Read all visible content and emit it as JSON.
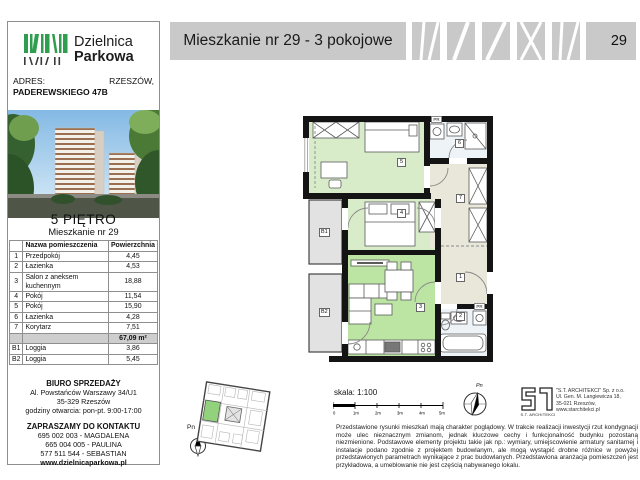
{
  "header": {
    "logo_line1": "Dzielnica",
    "logo_line2": "Parkowa",
    "address_label": "ADRES:",
    "address_city": "RZESZÓW,",
    "address_street": "PADEREWSKIEGO 47B",
    "title": "Mieszkanie nr 29 - 3 pokojowe",
    "unit_number": "29"
  },
  "left_panel": {
    "floor": "5 PIĘTRO",
    "unit": "Mieszkanie nr 29",
    "table": {
      "col_name": "Nazwa pomieszczenia",
      "col_area": "Powierzchnia",
      "rows": [
        {
          "no": "1",
          "name": "Przedpokój",
          "area": "4,45"
        },
        {
          "no": "2",
          "name": "Łazienka",
          "area": "4,53"
        },
        {
          "no": "3",
          "name": "Salon z aneksem kuchennym",
          "area": "18,88"
        },
        {
          "no": "4",
          "name": "Pokój",
          "area": "11,54"
        },
        {
          "no": "5",
          "name": "Pokój",
          "area": "15,90"
        },
        {
          "no": "6",
          "name": "Łazienka",
          "area": "4,28"
        },
        {
          "no": "7",
          "name": "Korytarz",
          "area": "7,51"
        }
      ],
      "total": "67,09 m²",
      "extra_rows": [
        {
          "no": "B1",
          "name": "Loggia",
          "area": "3,86"
        },
        {
          "no": "B2",
          "name": "Loggia",
          "area": "5,45"
        }
      ]
    },
    "office": {
      "title": "BIURO SPRZEDAŻY",
      "line1": "Al. Powstańców Warszawy 34/U1",
      "line2": "35-329 Rzeszów",
      "line3": "godziny otwarcia: pon-pt. 9:00-17:00",
      "contact_title": "ZAPRASZAMY DO KONTAKTU",
      "phone1": "695 002 003 - MAGDALENA",
      "phone2": "665 004 005 - PAULINA",
      "phone3": "577 511 544 - SEBASTIAN",
      "website": "www.dzielnicaparkowa.pl"
    }
  },
  "plan": {
    "room_labels": {
      "r1": "1",
      "r2": "2",
      "r3": "3",
      "r4": "4",
      "r5": "5",
      "r6": "6",
      "r7": "7",
      "b1": "B1",
      "b2": "B2"
    },
    "appliance_labels": {
      "pr_top": "PR",
      "pr_bottom": "PR"
    }
  },
  "footer": {
    "scale_label": "skala: 1:100",
    "scale_ticks": [
      "0",
      "1m",
      "2m",
      "3m",
      "4m",
      "5m"
    ],
    "north_label": "Pn",
    "architect": {
      "caption": "S.T. ARCHITEKCI",
      "line1": "\"S.T. ARCHITEKCI\" Sp. z o.o.",
      "line2": "Ul. Gen. M. Langiewicza 18,",
      "line3": "35-021 Rzeszów,",
      "line4": "www.starchitekci.pl"
    },
    "disclaimer": "Przedstawione rysunki mieszkań mają charakter poglądowy. W trakcie realizacji inwestycji rzut kondygnacji może ulec nieznacznym zmianom, jednak kluczowe cechy i funkcjonalność budynku pozostaną niezmienione. Podstawowe elementy projektu takie jak np.: wymiary, umiejscowienie armatury sanitarnej i instalacje podano zgodnie z projektem budowlanym, ale mogą wystąpić drobne różnice w powyżej przedstawionych parametrach wynikające z prac budowlanych. Przedstawiona aranżacja pomieszczeń jest przykładowa, a umeblowanie nie jest częścią nabywanego lokalu."
  },
  "colors": {
    "brand_green": "#2f9e4f",
    "room_green": "#d8ecca",
    "living_green": "#bce5a3",
    "corridor_beige": "#e9e7d9",
    "bath_blue": "#eef3f8",
    "loggia_gray": "#e2e2e2",
    "band_gray": "#c9c9c9",
    "wall_black": "#141414"
  }
}
